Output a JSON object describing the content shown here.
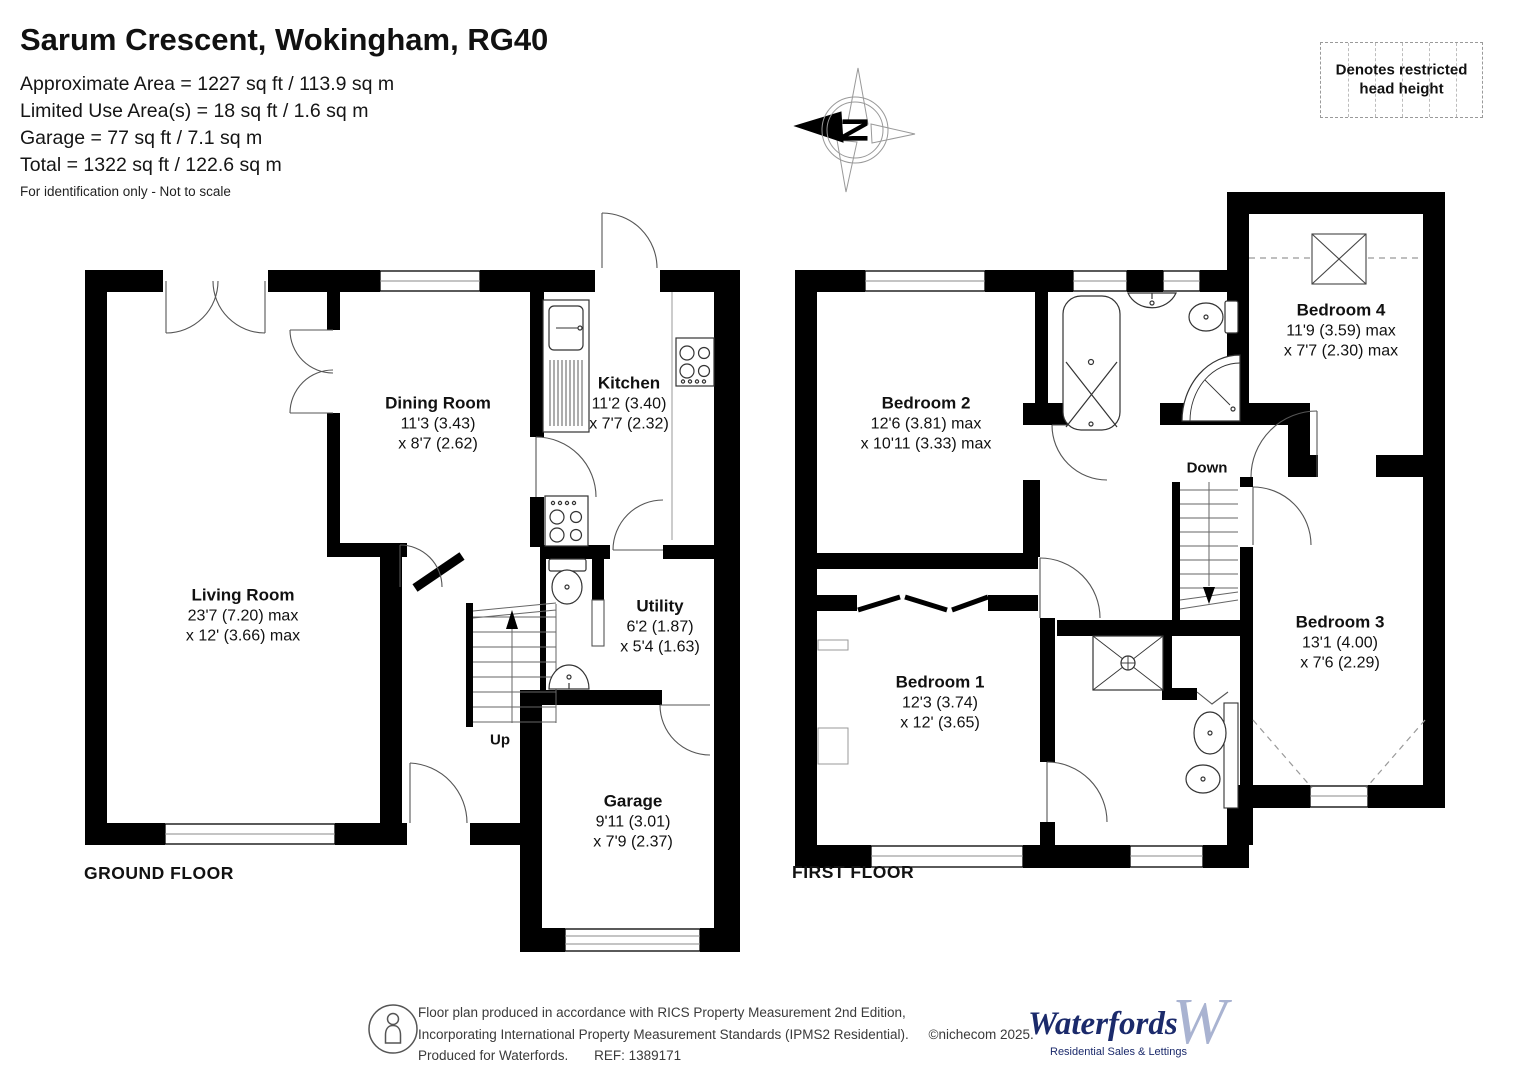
{
  "header": {
    "title": "Sarum Crescent, Wokingham, RG40",
    "area_lines": [
      "Approximate Area = 1227 sq ft / 113.9 sq m",
      "Limited Use Area(s) = 18 sq ft / 1.6 sq m",
      "Garage = 77 sq ft / 7.1 sq m",
      "Total = 1322 sq ft / 122.6 sq m"
    ],
    "disclaimer": "For identification only - Not to scale"
  },
  "legend": {
    "restricted_head_height": "Denotes restricted head height"
  },
  "compass": {
    "north_label": "N"
  },
  "floors": {
    "ground": {
      "label": "GROUND FLOOR",
      "stairs_label": "Up",
      "rooms": [
        {
          "name": "Living Room",
          "dim1": "23'7 (7.20) max",
          "dim2": "x 12' (3.66) max"
        },
        {
          "name": "Dining Room",
          "dim1": "11'3 (3.43)",
          "dim2": "x 8'7 (2.62)"
        },
        {
          "name": "Kitchen",
          "dim1": "11'2 (3.40)",
          "dim2": "x 7'7 (2.32)"
        },
        {
          "name": "Utility",
          "dim1": "6'2 (1.87)",
          "dim2": "x 5'4 (1.63)"
        },
        {
          "name": "Garage",
          "dim1": "9'11 (3.01)",
          "dim2": "x 7'9 (2.37)"
        }
      ]
    },
    "first": {
      "label": "FIRST FLOOR",
      "stairs_label": "Down",
      "rooms": [
        {
          "name": "Bedroom 1",
          "dim1": "12'3 (3.74)",
          "dim2": "x 12' (3.65)"
        },
        {
          "name": "Bedroom 2",
          "dim1": "12'6 (3.81) max",
          "dim2": "x 10'11 (3.33) max"
        },
        {
          "name": "Bedroom 3",
          "dim1": "13'1 (4.00)",
          "dim2": "x 7'6 (2.29)"
        },
        {
          "name": "Bedroom 4",
          "dim1": "11'9 (3.59) max",
          "dim2": "x 7'7 (2.30) max"
        }
      ]
    }
  },
  "footer": {
    "rics_line1": "Floor plan produced in accordance with RICS Property Measurement 2nd Edition,",
    "rics_line2": "Incorporating International Property Measurement Standards (IPMS2 Residential).",
    "copyright": "©nichecom 2025.",
    "produced_line": "Produced for Waterfords.",
    "ref": "REF: 1389171",
    "brand": {
      "name": "Waterfords",
      "w_mark": "W",
      "tagline": "Residential Sales & Lettings",
      "color": "#1b2a6b",
      "w_color": "#a9b3d1"
    }
  }
}
